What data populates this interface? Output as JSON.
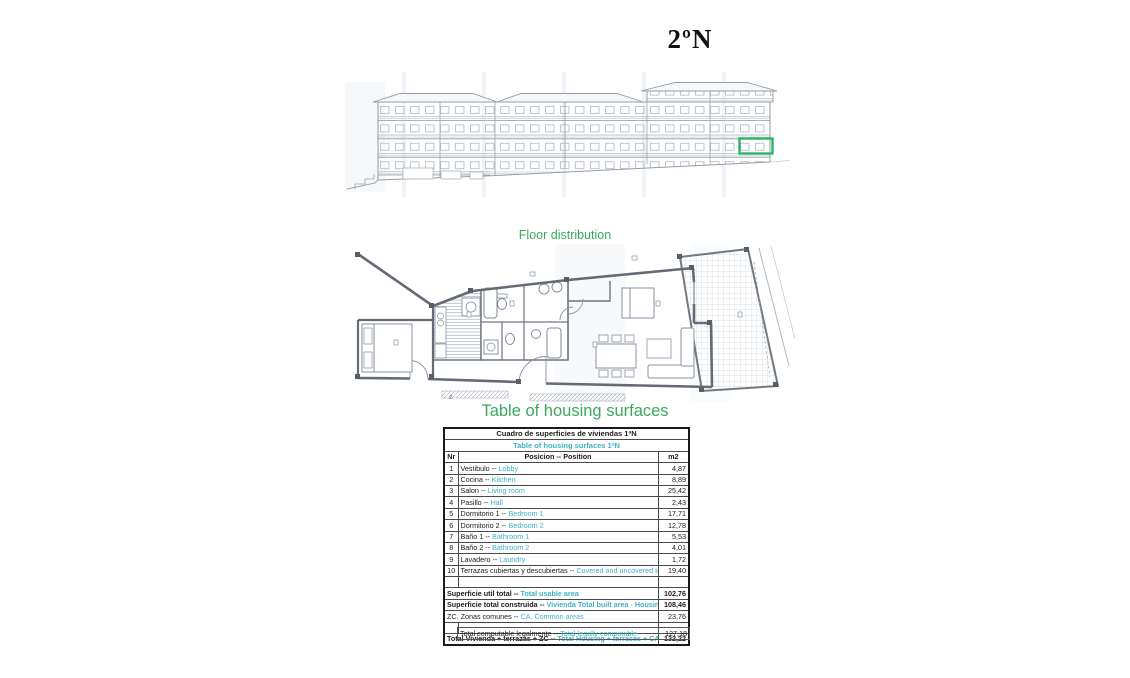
{
  "page": {
    "title": "2ºN"
  },
  "floor_plan": {
    "label": "Floor distribution",
    "stair_mark": "z"
  },
  "surfaces_heading": "Table of housing surfaces",
  "table": {
    "title_es": "Cuadro de superficies de viviendas 1ªN",
    "title_en": "Table of housing surfaces 1ªN",
    "col_nr": "Nr",
    "col_pos": "Posicion -- Position",
    "col_m2": "m2",
    "sep": "--",
    "rows": [
      {
        "nr": "1",
        "es": "Vestibulo",
        "en": "Lobby",
        "m2": "4,87"
      },
      {
        "nr": "2",
        "es": "Cocina",
        "en": "Kitchen",
        "m2": "8,89"
      },
      {
        "nr": "3",
        "es": "Salon",
        "en": "Living room",
        "m2": "25,42"
      },
      {
        "nr": "4",
        "es": "Pasillo",
        "en": "Hall",
        "m2": "2,43"
      },
      {
        "nr": "5",
        "es": "Dormitorio 1",
        "en": "Bedroom 1",
        "m2": "17,71"
      },
      {
        "nr": "6",
        "es": "Dormitorio 2",
        "en": "Bedroom 2",
        "m2": "12,78"
      },
      {
        "nr": "7",
        "es": "Baño 1",
        "en": "Bathroom 1",
        "m2": "5,53"
      },
      {
        "nr": "8",
        "es": "Baño 2",
        "en": "Bathroom 2",
        "m2": "4,01"
      },
      {
        "nr": "9",
        "es": "Lavadero",
        "en": "Laundry",
        "m2": "1,72"
      },
      {
        "nr": "10",
        "es": "Terrazas cubiertas y descubiertas",
        "en": "Covered and uncovered terraces",
        "m2": "19,40"
      }
    ],
    "summary": [
      {
        "es": "Superficie util total",
        "en": "Total usable area",
        "m2": "102,76"
      },
      {
        "es": "Superficie total construida",
        "en": "Vivienda Total built area - Housing",
        "m2": "108,46"
      },
      {
        "es": "ZC. Zonas comunes",
        "en": "CA. Common areas",
        "m2": "23,76"
      }
    ],
    "total": {
      "es": "Total Vivienda + terrazas + ZC",
      "en": "Total Housing + terraces + CA",
      "m2": "132,22"
    },
    "legal": {
      "es": "Total computable legalmente",
      "en": "Total legally computable",
      "m2": "127,18"
    }
  },
  "colors": {
    "heading_green": "#3aa95c",
    "translation_teal": "#3db1c6",
    "highlight_box_green": "#2db566"
  }
}
